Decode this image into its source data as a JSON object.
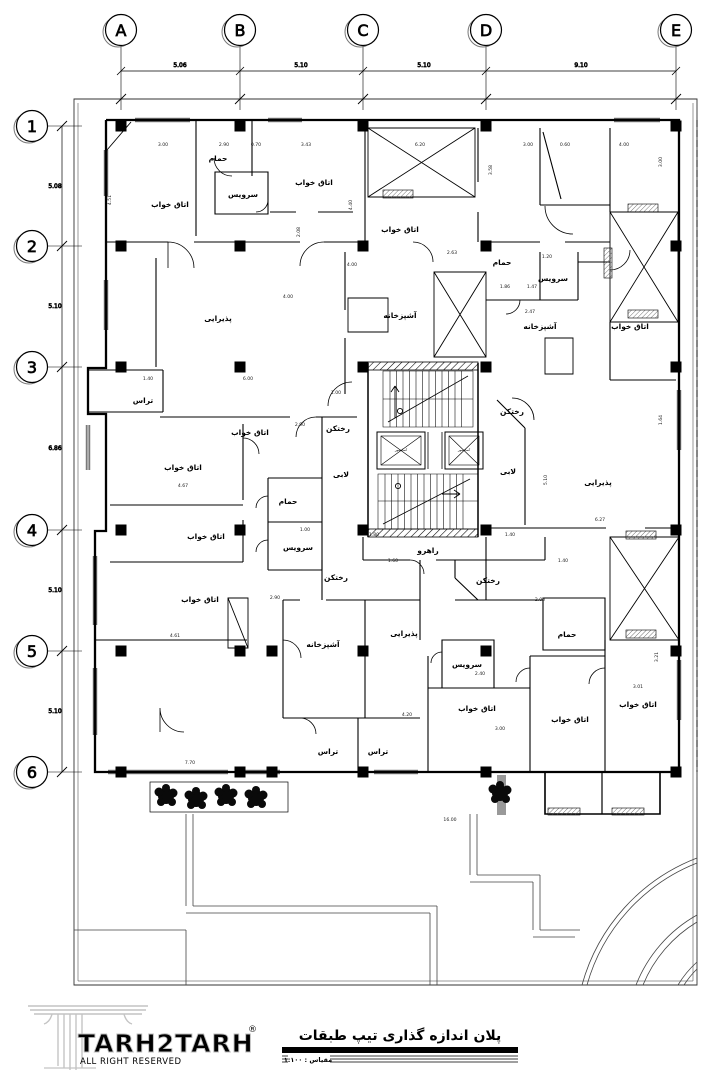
{
  "grid": {
    "cols": [
      {
        "label": "A",
        "x": 121
      },
      {
        "label": "B",
        "x": 240
      },
      {
        "label": "C",
        "x": 363
      },
      {
        "label": "D",
        "x": 486
      },
      {
        "label": "E",
        "x": 676
      }
    ],
    "rows": [
      {
        "label": "1",
        "y": 126
      },
      {
        "label": "2",
        "y": 246
      },
      {
        "label": "3",
        "y": 367
      },
      {
        "label": "4",
        "y": 530
      },
      {
        "label": "5",
        "y": 651
      },
      {
        "label": "6",
        "y": 772
      }
    ],
    "col_dims": [
      {
        "t": "5.06",
        "x": 180
      },
      {
        "t": "5.10",
        "x": 301
      },
      {
        "t": "5.10",
        "x": 424
      },
      {
        "t": "9.10",
        "x": 581
      }
    ],
    "row_dims": [
      {
        "t": "5.08",
        "y": 188
      },
      {
        "t": "5.10",
        "y": 308
      },
      {
        "t": "6.86",
        "y": 450
      },
      {
        "t": "5.10",
        "y": 592
      },
      {
        "t": "5.10",
        "y": 713
      }
    ]
  },
  "rooms": [
    {
      "label": "حمام",
      "x": 218,
      "y": 161
    },
    {
      "label": "اتاق خواب",
      "x": 170,
      "y": 207
    },
    {
      "label": "سرویس",
      "x": 243,
      "y": 197
    },
    {
      "label": "اتاق خواب",
      "x": 314,
      "y": 185
    },
    {
      "label": "اتاق خواب",
      "x": 400,
      "y": 232
    },
    {
      "label": "پذیرایی",
      "x": 218,
      "y": 321
    },
    {
      "label": "آشپزخانه",
      "x": 400,
      "y": 318
    },
    {
      "label": "حمام",
      "x": 502,
      "y": 265
    },
    {
      "label": "سرویس",
      "x": 553,
      "y": 281
    },
    {
      "label": "آشپزخانه",
      "x": 540,
      "y": 329
    },
    {
      "label": "اتاق خواب",
      "x": 630,
      "y": 329
    },
    {
      "label": "تراس",
      "x": 143,
      "y": 403
    },
    {
      "label": "اتاق خواب",
      "x": 250,
      "y": 435
    },
    {
      "label": "رختکن",
      "x": 338,
      "y": 431
    },
    {
      "label": "لابی",
      "x": 341,
      "y": 477
    },
    {
      "label": "رختکن",
      "x": 512,
      "y": 414
    },
    {
      "label": "لابی",
      "x": 508,
      "y": 474
    },
    {
      "label": "پذیرایی",
      "x": 598,
      "y": 485
    },
    {
      "label": "اتاق خواب",
      "x": 183,
      "y": 470
    },
    {
      "label": "حمام",
      "x": 288,
      "y": 504
    },
    {
      "label": "اتاق خواب",
      "x": 206,
      "y": 539
    },
    {
      "label": "سرویس",
      "x": 298,
      "y": 550
    },
    {
      "label": "رختکن",
      "x": 336,
      "y": 580
    },
    {
      "label": "رختکن",
      "x": 488,
      "y": 583
    },
    {
      "label": "راهرو",
      "x": 428,
      "y": 553
    },
    {
      "label": "اتاق خواب",
      "x": 200,
      "y": 602
    },
    {
      "label": "آشپزخانه",
      "x": 323,
      "y": 647
    },
    {
      "label": "پذیرایی",
      "x": 404,
      "y": 636
    },
    {
      "label": "سرویس",
      "x": 467,
      "y": 667
    },
    {
      "label": "حمام",
      "x": 567,
      "y": 637
    },
    {
      "label": "اتاق خواب",
      "x": 477,
      "y": 711
    },
    {
      "label": "اتاق خواب",
      "x": 570,
      "y": 722
    },
    {
      "label": "اتاق خواب",
      "x": 638,
      "y": 707
    },
    {
      "label": "تراس",
      "x": 328,
      "y": 754
    },
    {
      "label": "تراس",
      "x": 378,
      "y": 754
    }
  ],
  "elevators": [
    {
      "label": "آسانسور",
      "x": 401,
      "y": 451
    },
    {
      "label": "آسانسور",
      "x": 464,
      "y": 451
    }
  ],
  "dims": [
    {
      "t": "3.00",
      "x": 163,
      "y": 146
    },
    {
      "t": "2.90",
      "x": 224,
      "y": 146
    },
    {
      "t": "0.70",
      "x": 256,
      "y": 146
    },
    {
      "t": "3.43",
      "x": 306,
      "y": 146
    },
    {
      "t": "6.20",
      "x": 420,
      "y": 146
    },
    {
      "t": "3.00",
      "x": 528,
      "y": 146
    },
    {
      "t": "0.60",
      "x": 565,
      "y": 146
    },
    {
      "t": "4.00",
      "x": 624,
      "y": 146
    },
    {
      "t": "2.63",
      "x": 452,
      "y": 254
    },
    {
      "t": "4.00",
      "x": 352,
      "y": 266
    },
    {
      "t": "1.20",
      "x": 547,
      "y": 258
    },
    {
      "t": "1.86",
      "x": 505,
      "y": 288
    },
    {
      "t": "1.47",
      "x": 532,
      "y": 288
    },
    {
      "t": "2.47",
      "x": 530,
      "y": 313
    },
    {
      "t": "4.00",
      "x": 288,
      "y": 298
    },
    {
      "t": "1.00",
      "x": 336,
      "y": 394
    },
    {
      "t": "1.40",
      "x": 148,
      "y": 380
    },
    {
      "t": "6.00",
      "x": 248,
      "y": 380
    },
    {
      "t": "2.90",
      "x": 300,
      "y": 426
    },
    {
      "t": "4.67",
      "x": 183,
      "y": 487
    },
    {
      "t": "1.00",
      "x": 305,
      "y": 531
    },
    {
      "t": "2.90",
      "x": 275,
      "y": 599
    },
    {
      "t": "4.61",
      "x": 175,
      "y": 637
    },
    {
      "t": "2.00",
      "x": 540,
      "y": 601
    },
    {
      "t": "4.20",
      "x": 407,
      "y": 716
    },
    {
      "t": "3.00",
      "x": 500,
      "y": 730
    },
    {
      "t": "3.01",
      "x": 638,
      "y": 688
    },
    {
      "t": "6.27",
      "x": 600,
      "y": 521
    },
    {
      "t": "2.40",
      "x": 480,
      "y": 675
    },
    {
      "t": "1.60",
      "x": 393,
      "y": 562
    },
    {
      "t": "1.40",
      "x": 563,
      "y": 562
    },
    {
      "t": "7.70",
      "x": 190,
      "y": 764
    },
    {
      "t": "16.00",
      "x": 450,
      "y": 821
    },
    {
      "t": "1.80",
      "x": 374,
      "y": 536
    },
    {
      "t": "1.40",
      "x": 510,
      "y": 536
    },
    {
      "t": "4.51",
      "x": 111,
      "y": 200,
      "v": true
    },
    {
      "t": "4.40",
      "x": 352,
      "y": 205,
      "v": true
    },
    {
      "t": "3.00",
      "x": 662,
      "y": 162,
      "v": true
    },
    {
      "t": "1.64",
      "x": 662,
      "y": 420,
      "v": true
    },
    {
      "t": "3.21",
      "x": 658,
      "y": 657,
      "v": true
    },
    {
      "t": "2.08",
      "x": 300,
      "y": 232,
      "v": true
    },
    {
      "t": "3.58",
      "x": 492,
      "y": 170,
      "v": true
    },
    {
      "t": "5.10",
      "x": 547,
      "y": 480,
      "v": true
    }
  ],
  "titleblock": {
    "title": "پلان اندازه گذاری تیپ طبقات",
    "scale": "مقیاس : ۱:۱۰۰",
    "logo": "TARH2TARH",
    "logo_reg": "®",
    "logo_sub": "ALL RIGHT RESERVED"
  },
  "colors": {
    "line": "#000000",
    "background": "#ffffff",
    "logo_gray": "#c4c4c4"
  }
}
